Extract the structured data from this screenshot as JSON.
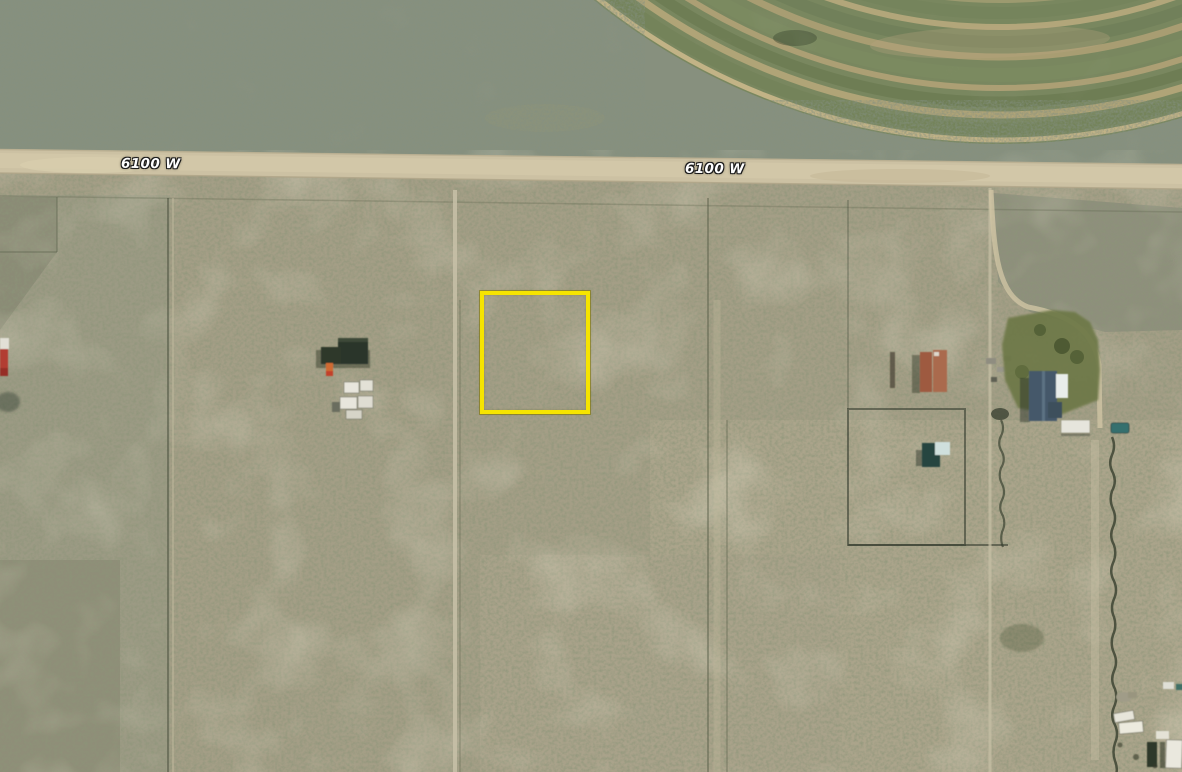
{
  "map": {
    "imagery": "satellite-aerial",
    "road": {
      "name": "6100 W"
    },
    "road_labels": [
      {
        "text": "6100 W"
      },
      {
        "text": "6100 W"
      }
    ],
    "parcel_highlight": {
      "shape": "rectangle",
      "color": "#f6e400",
      "border_px": 4
    },
    "palette": {
      "scrub_base": "#a49e86",
      "scrub_dark_upper": "#87907e",
      "road_surface": "#ccc1a3",
      "pivot_field_green": "#79875f",
      "pivot_arc_tan": "#b0a477",
      "lawn_green": "#6d7847",
      "house_roof_blue": "#44596b",
      "shed_dark_green": "#2a352a",
      "shed_teal": "#274540",
      "vehicle_white": "#e8e6dd",
      "truck_orange": "#d06a30",
      "car_teal": "#356f6e",
      "barn_red": "#b23c31",
      "fence_line": "#4a523c"
    }
  }
}
